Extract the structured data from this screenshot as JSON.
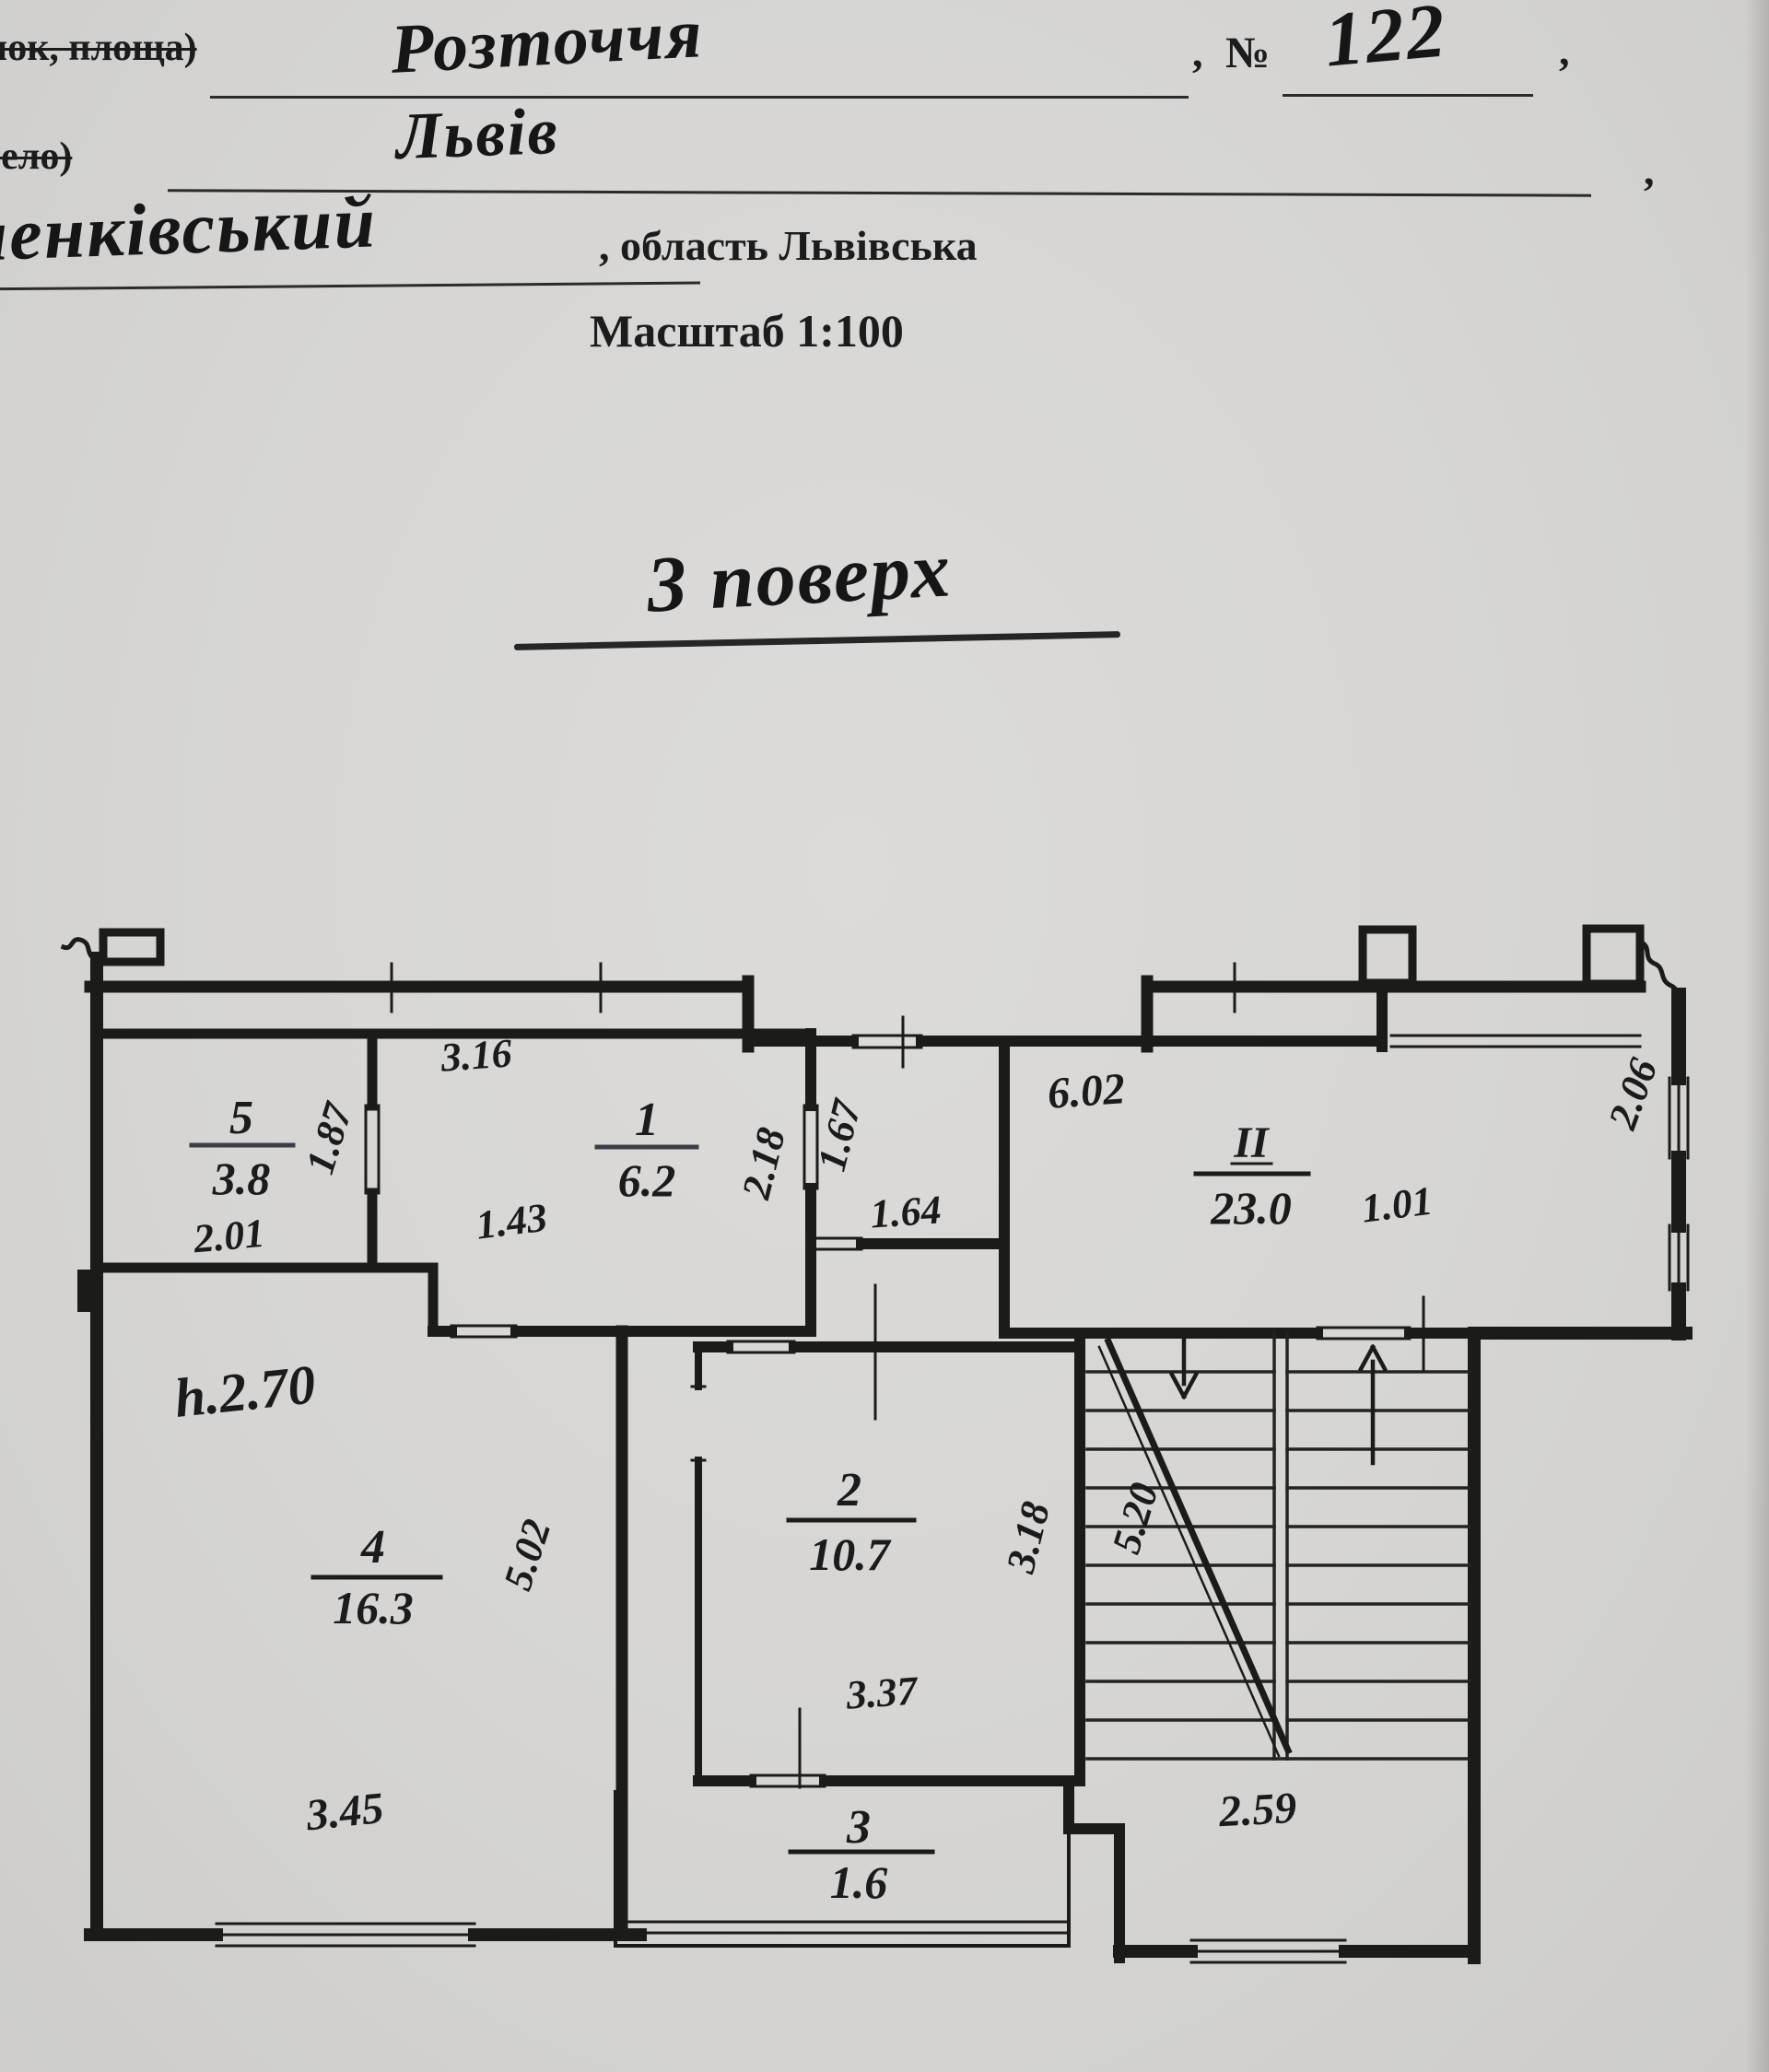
{
  "header": {
    "field1_label": "нок, площа)",
    "field1_value": "Розточчя",
    "number_sign": "№",
    "number_value": "122",
    "comma": ",",
    "field2_label": "село)",
    "field2_value": "Львів",
    "district_value": "ченківський",
    "district_suffix": ", область Львівська",
    "scale": "Масштаб 1:100",
    "floor_title": "3 поверх"
  },
  "plan": {
    "height_note": "h.2.70",
    "rooms": {
      "r5": {
        "num": "5",
        "area": "3.8"
      },
      "r1": {
        "num": "1",
        "area": "6.2"
      },
      "rII": {
        "num": "II",
        "area": "23.0"
      },
      "r2": {
        "num": "2",
        "area": "10.7"
      },
      "r4": {
        "num": "4",
        "area": "16.3"
      },
      "r3": {
        "num": "3",
        "area": "1.6"
      }
    },
    "dims": {
      "top5": "3.16",
      "door5": "1.87",
      "w5": "2.01",
      "hall": "1.43",
      "r1right": "2.18",
      "vest": "1.67",
      "iiTop": "6.02",
      "iiLeft": "1.64",
      "iiStep": "1.01",
      "iiRight": "2.06",
      "r4right": "5.02",
      "r2right": "3.18",
      "stair": "5.20",
      "r4bottom": "3.45",
      "r2bottom": "3.37",
      "stairBottom": "2.59"
    }
  }
}
